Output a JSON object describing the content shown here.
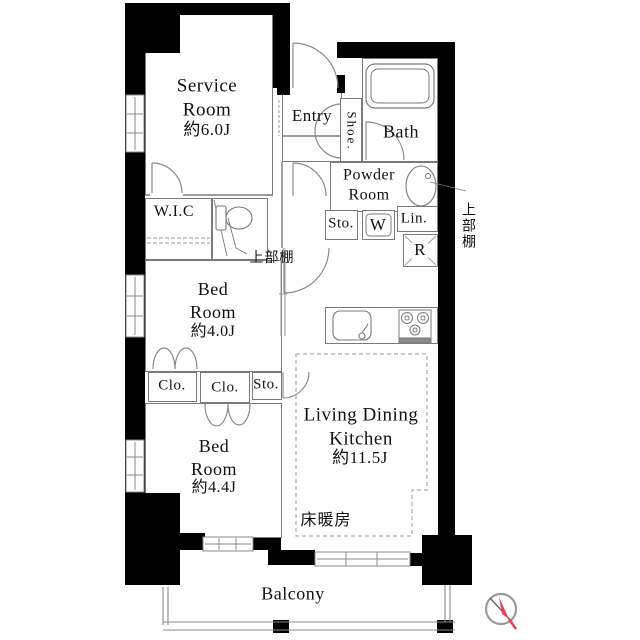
{
  "rooms": {
    "service_room": {
      "label": "Service Room",
      "size": "約6.0J"
    },
    "entry": {
      "label": "Entry"
    },
    "bath": {
      "label": "Bath"
    },
    "powder_room": {
      "label": "Powder Room"
    },
    "bed_room_1": {
      "label": "Bed Room",
      "size": "約4.0J"
    },
    "bed_room_2": {
      "label": "Bed Room",
      "size": "約4.4J"
    },
    "ldk": {
      "label": "Living Dining Kitchen",
      "size": "約11.5J"
    },
    "balcony": {
      "label": "Balcony"
    }
  },
  "storage": {
    "shoe": "Shoe.",
    "wic": "W.I.C",
    "hall_storage": "Sto.",
    "washer": "W",
    "linen": "Lin.",
    "fridge": "R",
    "closet_1": "Clo.",
    "closet_2": "Clo.",
    "bed_storage": "Sto."
  },
  "annotations": {
    "toilet_shelf": "上部棚",
    "wall_shelf": "上部棚",
    "floor_heating": "床暖房"
  },
  "colors": {
    "wall": "#000000",
    "line": "#7a7a7a",
    "text": "#111111",
    "compass_needle": "#e8415a"
  }
}
